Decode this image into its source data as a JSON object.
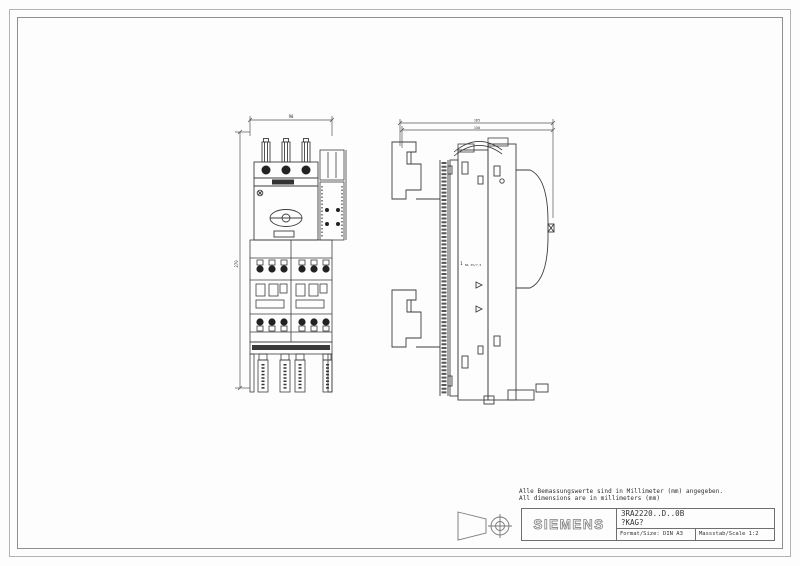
{
  "page": {
    "background": "#fdfdfd",
    "frame_color": "#8f8f8f"
  },
  "notes": {
    "de": "Alle Bemassungswerte sind in Millimeter (mm) angegeben.",
    "en": "All dimensions are in millimeters (mm)"
  },
  "title_block": {
    "brand": "SIEMENS",
    "product": "3RA2220..D..0B",
    "code": "?KAG?",
    "format": "Format/Size: DIN A3",
    "scale": "Massstab/Scale 1:2"
  },
  "views": {
    "front": {
      "name": "Front view of 3RA2220 load feeder on busbar adapter",
      "width_dim": "90",
      "height_dim": "270"
    },
    "side": {
      "name": "Side view of 3RA2220 load feeder on busbar adapter",
      "dim_outer": "165",
      "dim_inner": "150",
      "callout": "1",
      "rail_label": "NS 35/7,5"
    }
  },
  "symbols": {
    "projection": "first-angle projection symbol"
  }
}
